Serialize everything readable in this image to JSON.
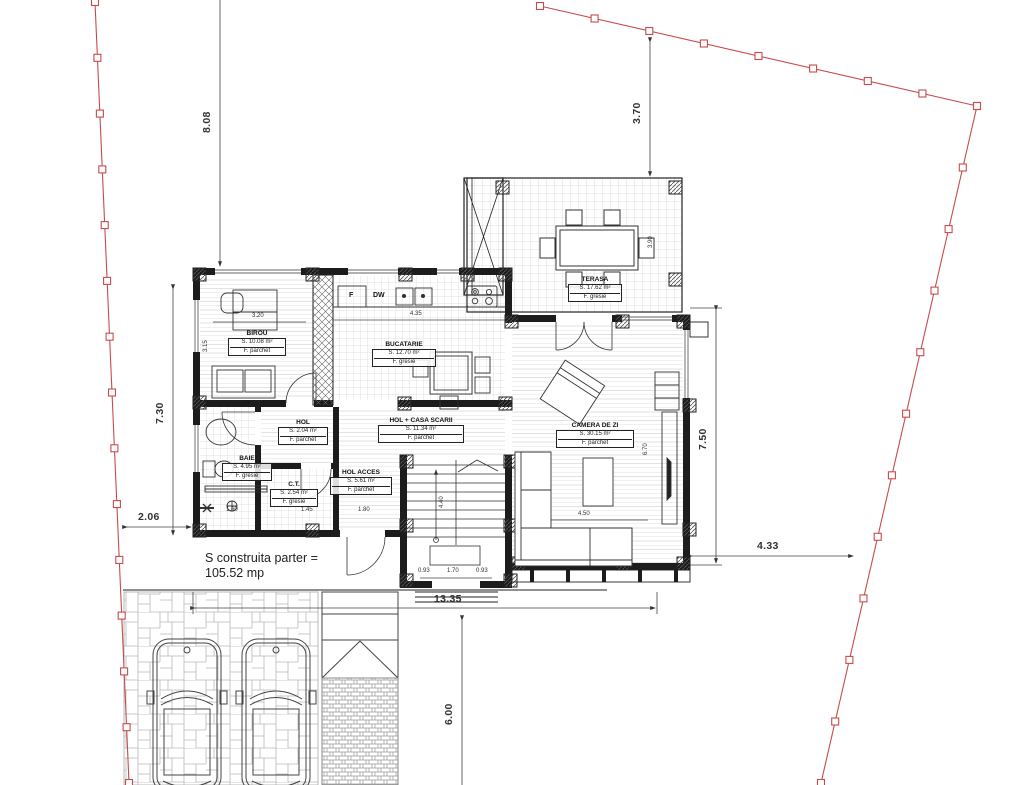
{
  "drawing": {
    "annotation": {
      "line1": "S construita parter =",
      "line2": "105.52 mp"
    },
    "rooms": {
      "birou": {
        "name": "BIROU",
        "area": "S. 10.08 m²",
        "floor": "F. parchet"
      },
      "bucatarie": {
        "name": "BUCATARIE",
        "area": "S. 12.70 m²",
        "floor": "F. gresie"
      },
      "hol": {
        "name": "HOL",
        "area": "S. 2.04 m²",
        "floor": "F. parchet"
      },
      "baie": {
        "name": "BAIE",
        "area": "S. 4.95 m²",
        "floor": "F. gresie"
      },
      "ct": {
        "name": "C.T.",
        "area": "S. 2.54 m²",
        "floor": "F. gresie"
      },
      "hol_acces": {
        "name": "HOL ACCES",
        "area": "S. 5.61 m²",
        "floor": "F. parchet"
      },
      "hol_casa_scarii": {
        "name": "HOL + CASA SCARII",
        "area": "S. 11.34 m²",
        "floor": "F. parchet"
      },
      "camera_de_zi": {
        "name": "CAMERA DE ZI",
        "area": "S. 30.15 m²",
        "floor": "F. parchet"
      },
      "terasa": {
        "name": "TERASA",
        "area": "S. 17.62 m²",
        "floor": "F. gresie"
      }
    },
    "appliances": {
      "fridge": "F",
      "dishwasher": "DW"
    },
    "dimensions": {
      "plot_left": "8.08",
      "plot_top_right": "3.70",
      "house_left": "7.30",
      "setback_left": "2.06",
      "house_right": "7.50",
      "setback_right": "4.33",
      "house_width": "13.35",
      "drive_depth": "6.00",
      "birou_width": "3.20",
      "kitchen_width": "4.35",
      "birou_depth": "3.15",
      "baie_width": "1.60",
      "ct_width": "1.45",
      "holacces_width": "1.80",
      "bay_a": "0.93",
      "bay_b": "1.70",
      "bay_c": "0.93",
      "living_width": "4.50",
      "living_depth": "6.70",
      "terasa_depth": "3.90",
      "stair_run": "4.40"
    },
    "colors": {
      "boundary": "#c84b4b",
      "line": "#222222"
    }
  }
}
